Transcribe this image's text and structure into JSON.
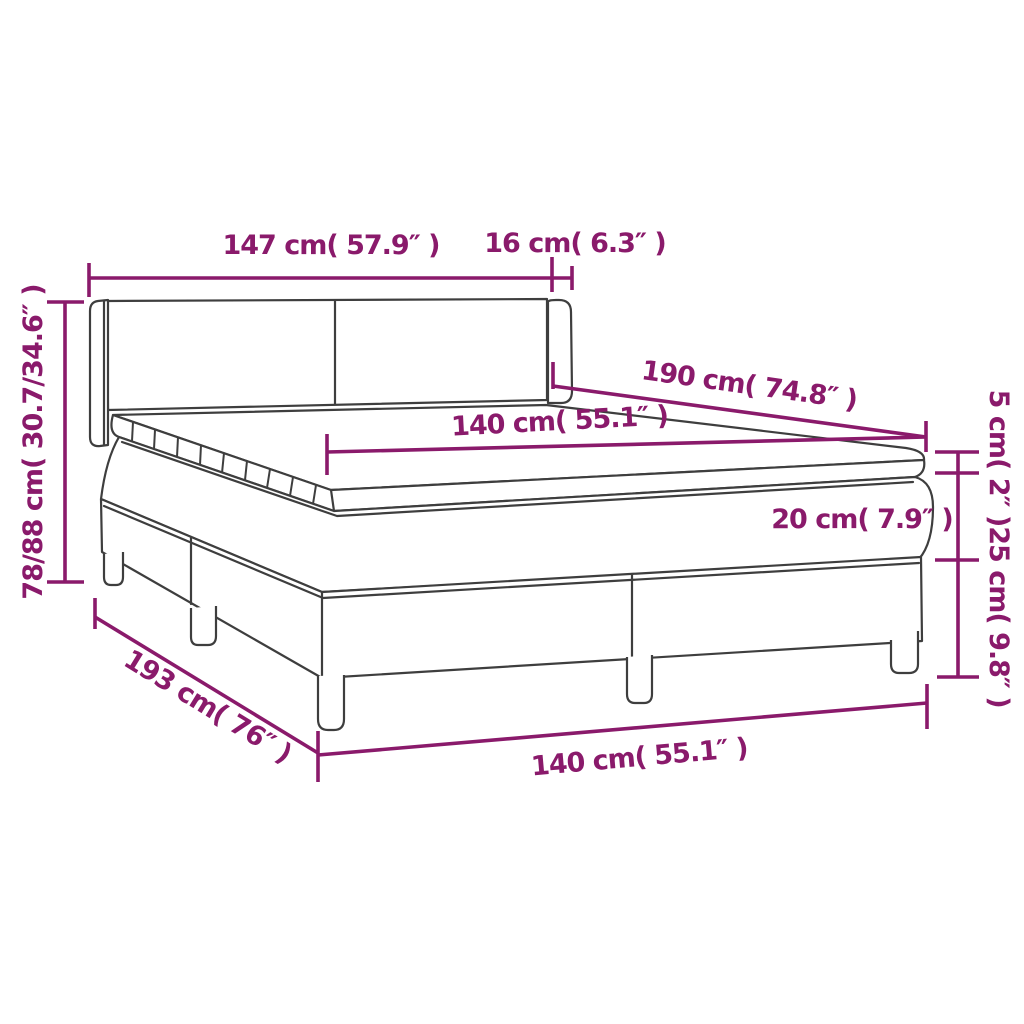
{
  "diagram": {
    "title": "Box spring bed with headboard and mattress topper - dimension diagram",
    "background_color": "#ffffff",
    "outline_color": "#3e3e3e",
    "dimension_color": "#8a1a6b",
    "dimensions": {
      "headboard_width": {
        "label": "147 cm( 57.9″ )",
        "cm": "147",
        "inches": "57.9"
      },
      "headboard_depth": {
        "label": "16 cm( 6.3″ )",
        "cm": "16",
        "inches": "6.3"
      },
      "headboard_height": {
        "label": "78/88 cm( 30.7/34.6″ )",
        "cm": "78/88",
        "inches": "30.7/34.6"
      },
      "bed_length_top": {
        "label": "190 cm( 74.8″ )",
        "cm": "190",
        "inches": "74.8"
      },
      "mattress_width": {
        "label": "140 cm( 55.1″ )",
        "cm": "140",
        "inches": "55.1"
      },
      "topper_height": {
        "label": "5 cm( 2″ )",
        "cm": "5",
        "inches": "2"
      },
      "mattress_height": {
        "label": "20 cm( 7.9″ )",
        "cm": "20",
        "inches": "7.9"
      },
      "base_height": {
        "label": "25 cm( 9.8″ )",
        "cm": "25",
        "inches": "9.8"
      },
      "bed_length_floor": {
        "label": "193 cm( 76″ )",
        "cm": "193",
        "inches": "76"
      },
      "bed_width_floor": {
        "label": "140 cm( 55.1″ )",
        "cm": "140",
        "inches": "55.1"
      }
    }
  }
}
